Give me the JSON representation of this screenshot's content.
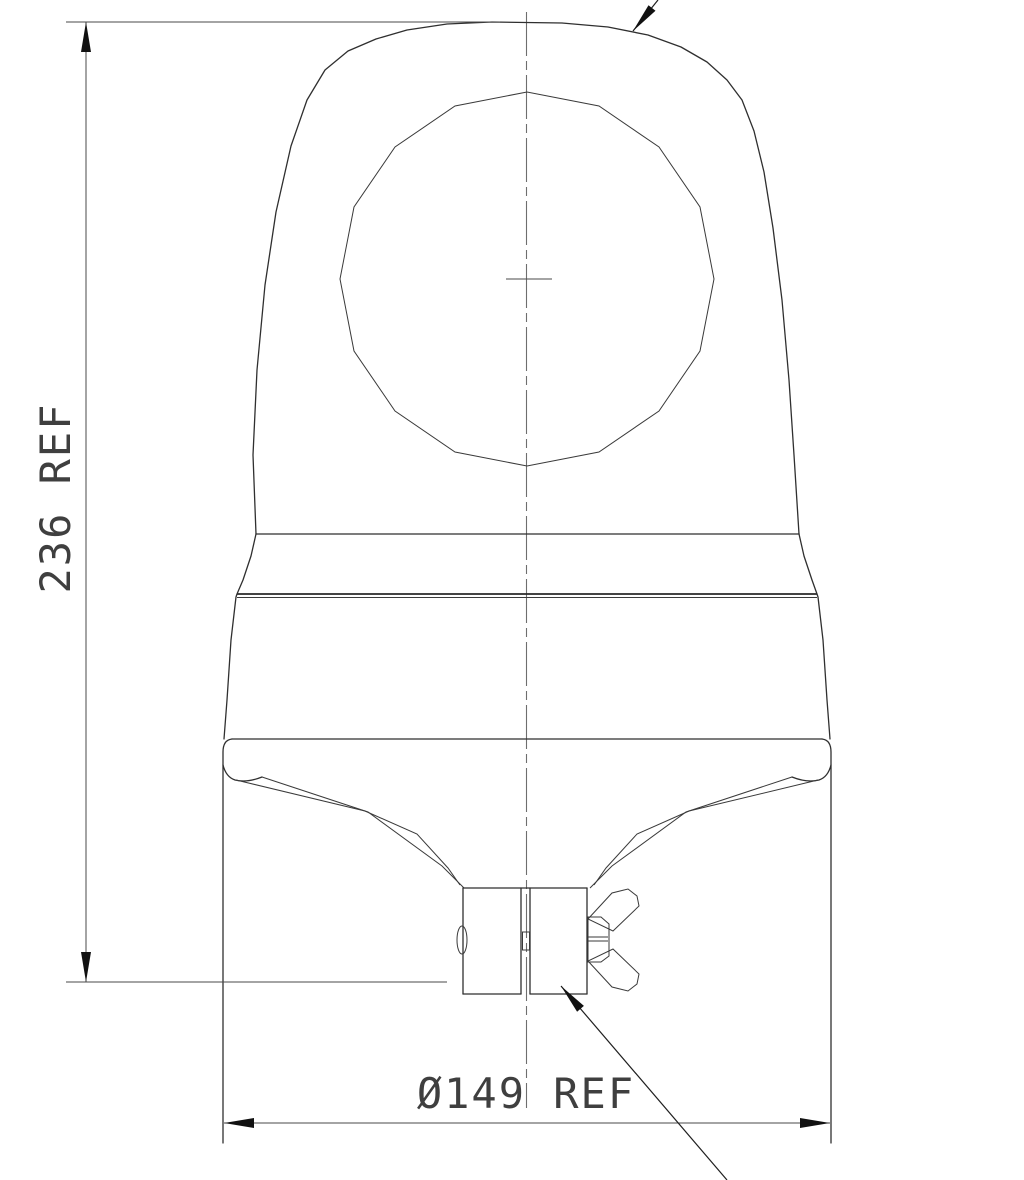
{
  "drawing": {
    "dimensions": {
      "height": {
        "label": "236 REF"
      },
      "diameter": {
        "label": "Ø149 REF"
      }
    },
    "colors": {
      "background": "#ffffff",
      "object_line": "#2f2f2f",
      "dimension_line": "#4a4a4a",
      "centerline": "#6e6e6e",
      "text": "#3f3f3f",
      "arrow_fill": "#111111"
    }
  }
}
